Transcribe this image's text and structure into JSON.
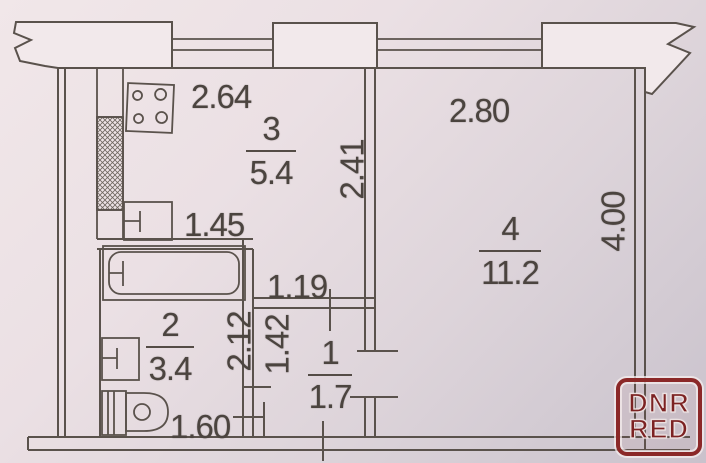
{
  "plan": {
    "title": "apartment floor plan (scanned)",
    "rooms": [
      {
        "number": "3",
        "area": "5.4"
      },
      {
        "number": "4",
        "area": "11.2"
      },
      {
        "number": "2",
        "area": "3.4"
      },
      {
        "number": "1",
        "area": "1.7"
      }
    ],
    "dimensions": {
      "kitchen_width": "2.64",
      "room4_width": "2.80",
      "kitchen_depth": "2.41",
      "room4_depth": "4.00",
      "sink_run": "1.45",
      "hall_width": "1.19",
      "hall_depth": "1.42",
      "bath_depth": "2.12",
      "bath_width": "1.60"
    },
    "fixtures": [
      "stove-icon",
      "kitchen-sink-icon",
      "vent-shaft-hatch",
      "bathtub-icon",
      "washbasin-icon",
      "toilet-icon"
    ],
    "colors": {
      "paper_light": "#f1e7e9",
      "paper_dark": "#c9c2cc",
      "line": "#5a524c",
      "logo_red": "#7c2222"
    }
  },
  "watermark": {
    "line1": "DNR",
    "line2": "RED"
  }
}
